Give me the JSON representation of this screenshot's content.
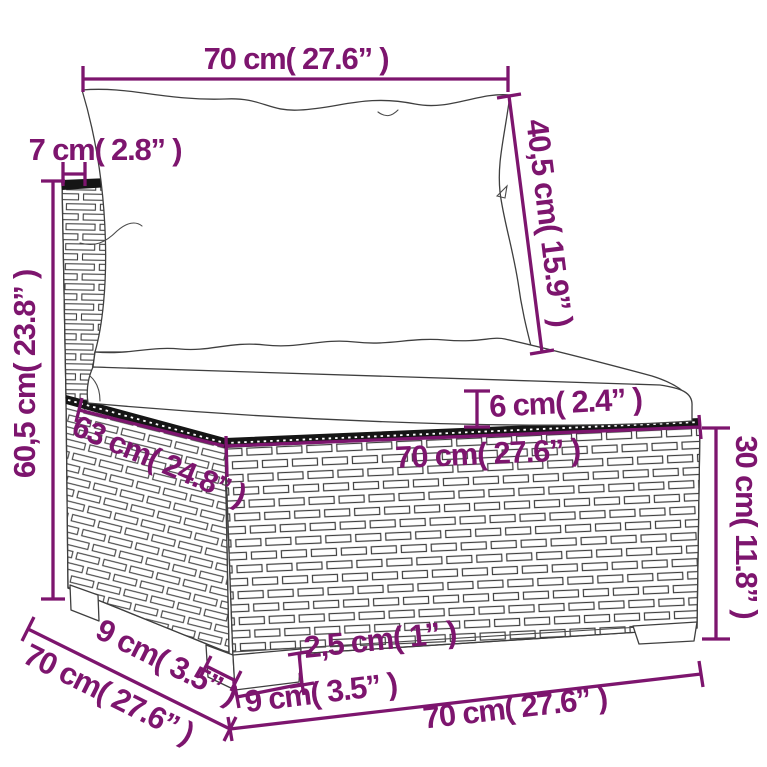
{
  "page": {
    "background": "#ffffff"
  },
  "diagram": {
    "subject": "poly rattan middle sofa section with back and seat cushions",
    "style": "technical dimension line drawing",
    "accent_color": "#7d156e",
    "lineart_color": "#3f3f3f"
  },
  "dimensions": {
    "back_cushion_width": "70 cm( 27.6” )",
    "back_panel_thickness": "7 cm( 2.8” )",
    "back_cushion_height": "40,5 cm( 15.9” )",
    "total_height": "60,5 cm( 23.8” )",
    "seat_cushion_thickness": "6 cm( 2.4” )",
    "seat_depth": "63 cm( 24.8” )",
    "seat_width": "70 cm( 27.6” )",
    "base_height": "30 cm( 11.8” )",
    "total_depth": "70 cm( 27.6” )",
    "leg_depth": "9 cm( 3.5” )",
    "leg_height": "2,5 cm( 1” )",
    "leg_width": "9 cm( 3.5” )",
    "base_width": "70 cm( 27.6” )"
  }
}
